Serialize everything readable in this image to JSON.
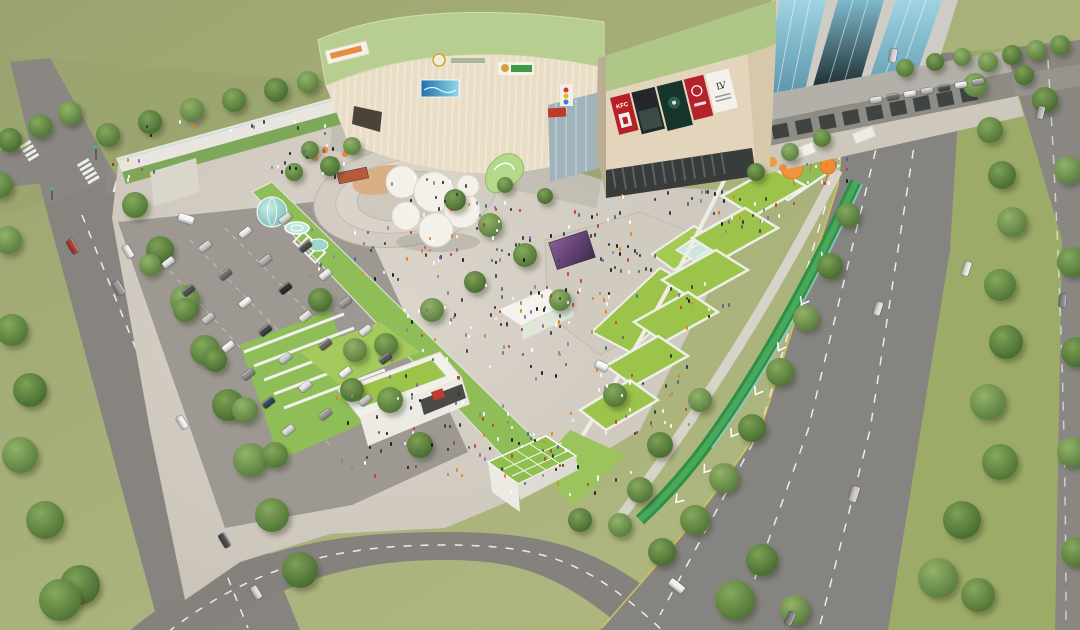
{
  "signs": {
    "billboard_kfc": "KFC",
    "billboard_lv": "LV"
  },
  "palette": {
    "ground_olive": "#a6b077",
    "road_grey": "#87847f",
    "plaza_grey": "#d2ccc3",
    "mall_roof_sage": "#b8ce91",
    "mall_facade_cream": "#e9ddc6",
    "green_roof": "#9cc44b",
    "lawn_green": "#8fbd58",
    "tree_green": "#587c3b",
    "canal_green": "#2e8f45",
    "glass_teal": "#8fd0cc",
    "tower_blue": "#6ea8bd",
    "balloon_orange": "#f0953e",
    "billboard_red": "#b92025",
    "billboard_darkgreen": "#15342a",
    "led_purple": "#6b4a7a"
  },
  "scene": {
    "trees": [
      [
        12,
        330,
        16,
        0
      ],
      [
        30,
        390,
        17,
        1
      ],
      [
        20,
        455,
        18,
        2
      ],
      [
        45,
        520,
        19,
        0
      ],
      [
        80,
        585,
        20,
        1
      ],
      [
        8,
        240,
        14,
        2
      ],
      [
        60,
        600,
        21,
        0
      ],
      [
        10,
        140,
        12,
        1
      ],
      [
        40,
        126,
        12,
        0
      ],
      [
        70,
        113,
        12,
        2
      ],
      [
        0,
        185,
        13,
        0
      ],
      [
        108,
        135,
        12,
        0
      ],
      [
        150,
        122,
        12,
        1
      ],
      [
        192,
        110,
        12,
        2
      ],
      [
        234,
        100,
        12,
        0
      ],
      [
        276,
        90,
        12,
        1
      ],
      [
        308,
        82,
        11,
        2
      ],
      [
        135,
        205,
        13,
        0
      ],
      [
        160,
        250,
        14,
        1
      ],
      [
        185,
        300,
        15,
        2
      ],
      [
        205,
        350,
        15,
        0
      ],
      [
        228,
        405,
        16,
        1
      ],
      [
        250,
        460,
        17,
        2
      ],
      [
        272,
        515,
        17,
        0
      ],
      [
        300,
        570,
        18,
        1
      ],
      [
        150,
        265,
        11,
        2
      ],
      [
        185,
        310,
        12,
        0
      ],
      [
        215,
        360,
        12,
        1
      ],
      [
        245,
        410,
        13,
        2
      ],
      [
        275,
        455,
        13,
        0
      ],
      [
        320,
        300,
        12,
        1
      ],
      [
        355,
        350,
        12,
        2
      ],
      [
        390,
        400,
        13,
        0
      ],
      [
        420,
        445,
        13,
        1
      ],
      [
        310,
        150,
        9,
        0
      ],
      [
        330,
        166,
        10,
        1
      ],
      [
        352,
        146,
        9,
        2
      ],
      [
        294,
        172,
        9,
        0
      ],
      [
        455,
        200,
        11,
        1
      ],
      [
        490,
        225,
        12,
        2
      ],
      [
        525,
        255,
        12,
        0
      ],
      [
        475,
        282,
        11,
        1
      ],
      [
        432,
        310,
        12,
        2
      ],
      [
        386,
        345,
        12,
        0
      ],
      [
        352,
        390,
        12,
        1
      ],
      [
        560,
        300,
        11,
        2
      ],
      [
        615,
        395,
        12,
        0
      ],
      [
        660,
        445,
        13,
        1
      ],
      [
        700,
        400,
        12,
        2
      ],
      [
        640,
        490,
        13,
        0
      ],
      [
        580,
        520,
        12,
        1
      ],
      [
        620,
        525,
        12,
        2
      ],
      [
        505,
        185,
        8,
        0
      ],
      [
        545,
        196,
        8,
        1
      ],
      [
        975,
        85,
        12,
        2
      ],
      [
        990,
        130,
        13,
        0
      ],
      [
        1002,
        175,
        14,
        1
      ],
      [
        1012,
        222,
        15,
        2
      ],
      [
        1000,
        285,
        16,
        0
      ],
      [
        1006,
        342,
        17,
        1
      ],
      [
        988,
        402,
        18,
        2
      ],
      [
        1000,
        462,
        18,
        0
      ],
      [
        962,
        520,
        19,
        1
      ],
      [
        938,
        578,
        20,
        2
      ],
      [
        978,
        595,
        17,
        0
      ],
      [
        1045,
        100,
        13,
        1
      ],
      [
        1068,
        170,
        14,
        2
      ],
      [
        1072,
        262,
        15,
        0
      ],
      [
        1076,
        352,
        15,
        1
      ],
      [
        1072,
        452,
        15,
        2
      ],
      [
        1076,
        552,
        15,
        0
      ],
      [
        1012,
        55,
        10,
        1
      ],
      [
        1036,
        50,
        10,
        2
      ],
      [
        1060,
        45,
        10,
        0
      ],
      [
        1024,
        75,
        10,
        1
      ],
      [
        988,
        62,
        10,
        2
      ],
      [
        848,
        215,
        12,
        0
      ],
      [
        830,
        266,
        13,
        1
      ],
      [
        806,
        318,
        13,
        2
      ],
      [
        780,
        372,
        14,
        0
      ],
      [
        752,
        428,
        14,
        1
      ],
      [
        724,
        478,
        15,
        2
      ],
      [
        695,
        520,
        15,
        0
      ],
      [
        662,
        552,
        14,
        1
      ],
      [
        790,
        152,
        9,
        2
      ],
      [
        822,
        138,
        9,
        0
      ],
      [
        756,
        172,
        9,
        1
      ],
      [
        905,
        68,
        9,
        0
      ],
      [
        935,
        62,
        9,
        1
      ],
      [
        962,
        57,
        9,
        2
      ],
      [
        735,
        600,
        20,
        0
      ],
      [
        762,
        560,
        16,
        1
      ],
      [
        795,
        610,
        15,
        2
      ]
    ],
    "cars": [
      [
        72,
        246,
        15,
        7,
        59,
        "#b04038"
      ],
      [
        128,
        251,
        14,
        7,
        59,
        "#ececec"
      ],
      [
        118,
        288,
        15,
        8,
        59,
        "#9b9b9b"
      ],
      [
        182,
        422,
        14,
        7,
        59,
        "#f0f0f0"
      ],
      [
        224,
        540,
        15,
        7,
        59,
        "#4e4e4e"
      ],
      [
        256,
        592,
        14,
        7,
        59,
        "#dddddd"
      ],
      [
        186,
        219,
        16,
        8,
        17,
        "#f5f5f3"
      ],
      [
        966,
        268,
        15,
        7,
        108,
        "#e8e8e8"
      ],
      [
        878,
        308,
        14,
        7,
        108,
        "#dedede"
      ],
      [
        854,
        494,
        16,
        8,
        108,
        "#cfcdc2"
      ],
      [
        893,
        55,
        14,
        7,
        100,
        "#d6d6d6"
      ],
      [
        790,
        618,
        14,
        7,
        115,
        "#8a8a8a"
      ],
      [
        1040,
        112,
        13,
        7,
        105,
        "#bdbdbd"
      ],
      [
        1062,
        300,
        13,
        7,
        95,
        "#8f8f8f"
      ],
      [
        676,
        586,
        17,
        8,
        38,
        "#f2f2f0"
      ],
      [
        601,
        366,
        13,
        8,
        25,
        "#f7f7f5"
      ],
      [
        876,
        100,
        12,
        6,
        -10,
        "#dcdcdc"
      ],
      [
        893,
        97,
        12,
        6,
        -10,
        "#6f6f6f"
      ],
      [
        910,
        94,
        12,
        6,
        -10,
        "#ececec"
      ],
      [
        927,
        91,
        12,
        6,
        -10,
        "#c9c9c9"
      ],
      [
        944,
        88,
        12,
        6,
        -10,
        "#525252"
      ],
      [
        961,
        85,
        12,
        6,
        -10,
        "#efefef"
      ],
      [
        978,
        82,
        12,
        6,
        -10,
        "#a8a8a8"
      ],
      [
        168,
        262,
        13,
        7,
        -38,
        "#e8e8e8"
      ],
      [
        188,
        290,
        13,
        7,
        -38,
        "#565656"
      ],
      [
        208,
        318,
        13,
        7,
        -38,
        "#c9c9c9"
      ],
      [
        228,
        346,
        13,
        7,
        -38,
        "#f0f0f0"
      ],
      [
        248,
        374,
        13,
        7,
        -38,
        "#8e8e8e"
      ],
      [
        268,
        402,
        13,
        7,
        -38,
        "#3a4a5a"
      ],
      [
        288,
        430,
        13,
        7,
        -38,
        "#dcdcdc"
      ],
      [
        205,
        246,
        13,
        7,
        -38,
        "#d0d0d0"
      ],
      [
        225,
        274,
        13,
        7,
        -38,
        "#6f6f6f"
      ],
      [
        245,
        302,
        13,
        7,
        -38,
        "#f2f2f2"
      ],
      [
        265,
        330,
        13,
        7,
        -38,
        "#454545"
      ],
      [
        285,
        358,
        13,
        7,
        -38,
        "#cfcfcf"
      ],
      [
        305,
        386,
        13,
        7,
        -38,
        "#e6e6e6"
      ],
      [
        325,
        414,
        13,
        7,
        -38,
        "#9a9a9a"
      ],
      [
        245,
        232,
        13,
        7,
        -38,
        "#eeeeee"
      ],
      [
        265,
        260,
        13,
        7,
        -38,
        "#b5b5b5"
      ],
      [
        285,
        288,
        13,
        7,
        -38,
        "#2f2f2f"
      ],
      [
        305,
        316,
        13,
        7,
        -38,
        "#e2e2e2"
      ],
      [
        325,
        344,
        13,
        7,
        -38,
        "#6a6a6a"
      ],
      [
        345,
        372,
        13,
        7,
        -38,
        "#f5f5f5"
      ],
      [
        365,
        400,
        13,
        7,
        -38,
        "#c2c2c2"
      ],
      [
        285,
        218,
        13,
        7,
        -38,
        "#dadada"
      ],
      [
        305,
        246,
        13,
        7,
        -38,
        "#4f4f4f"
      ],
      [
        325,
        274,
        13,
        7,
        -38,
        "#ececec"
      ],
      [
        345,
        302,
        13,
        7,
        -38,
        "#9e9e9e"
      ],
      [
        365,
        330,
        13,
        7,
        -38,
        "#e8e8e8"
      ],
      [
        385,
        358,
        13,
        7,
        -38,
        "#5c5c5c"
      ]
    ],
    "people_clusters": [
      [
        468,
        232,
        62,
        32,
        46
      ],
      [
        556,
        296,
        66,
        38,
        40
      ],
      [
        486,
        334,
        84,
        44,
        42
      ],
      [
        420,
        424,
        92,
        50,
        46
      ],
      [
        543,
        462,
        66,
        32,
        28
      ],
      [
        624,
        252,
        40,
        24,
        20
      ],
      [
        756,
        212,
        42,
        18,
        22
      ],
      [
        818,
        170,
        28,
        13,
        14
      ],
      [
        352,
        252,
        44,
        26,
        16
      ],
      [
        300,
        160,
        44,
        18,
        16
      ],
      [
        648,
        402,
        52,
        30,
        18
      ],
      [
        700,
        302,
        30,
        20,
        12
      ],
      [
        228,
        128,
        100,
        8,
        14
      ],
      [
        672,
        200,
        58,
        12,
        18
      ],
      [
        590,
        222,
        40,
        14,
        12
      ],
      [
        430,
        188,
        40,
        12,
        12
      ],
      [
        520,
        370,
        170,
        110,
        55
      ],
      [
        130,
        168,
        24,
        10,
        10
      ]
    ],
    "people_colors": [
      "#2e3440",
      "#f7f7f4",
      "#c0392b",
      "#e67e22",
      "#4a6785",
      "#161616",
      "#7f8c8d",
      "#9b59b6",
      "#ffffff",
      "#3d3d3d"
    ]
  }
}
